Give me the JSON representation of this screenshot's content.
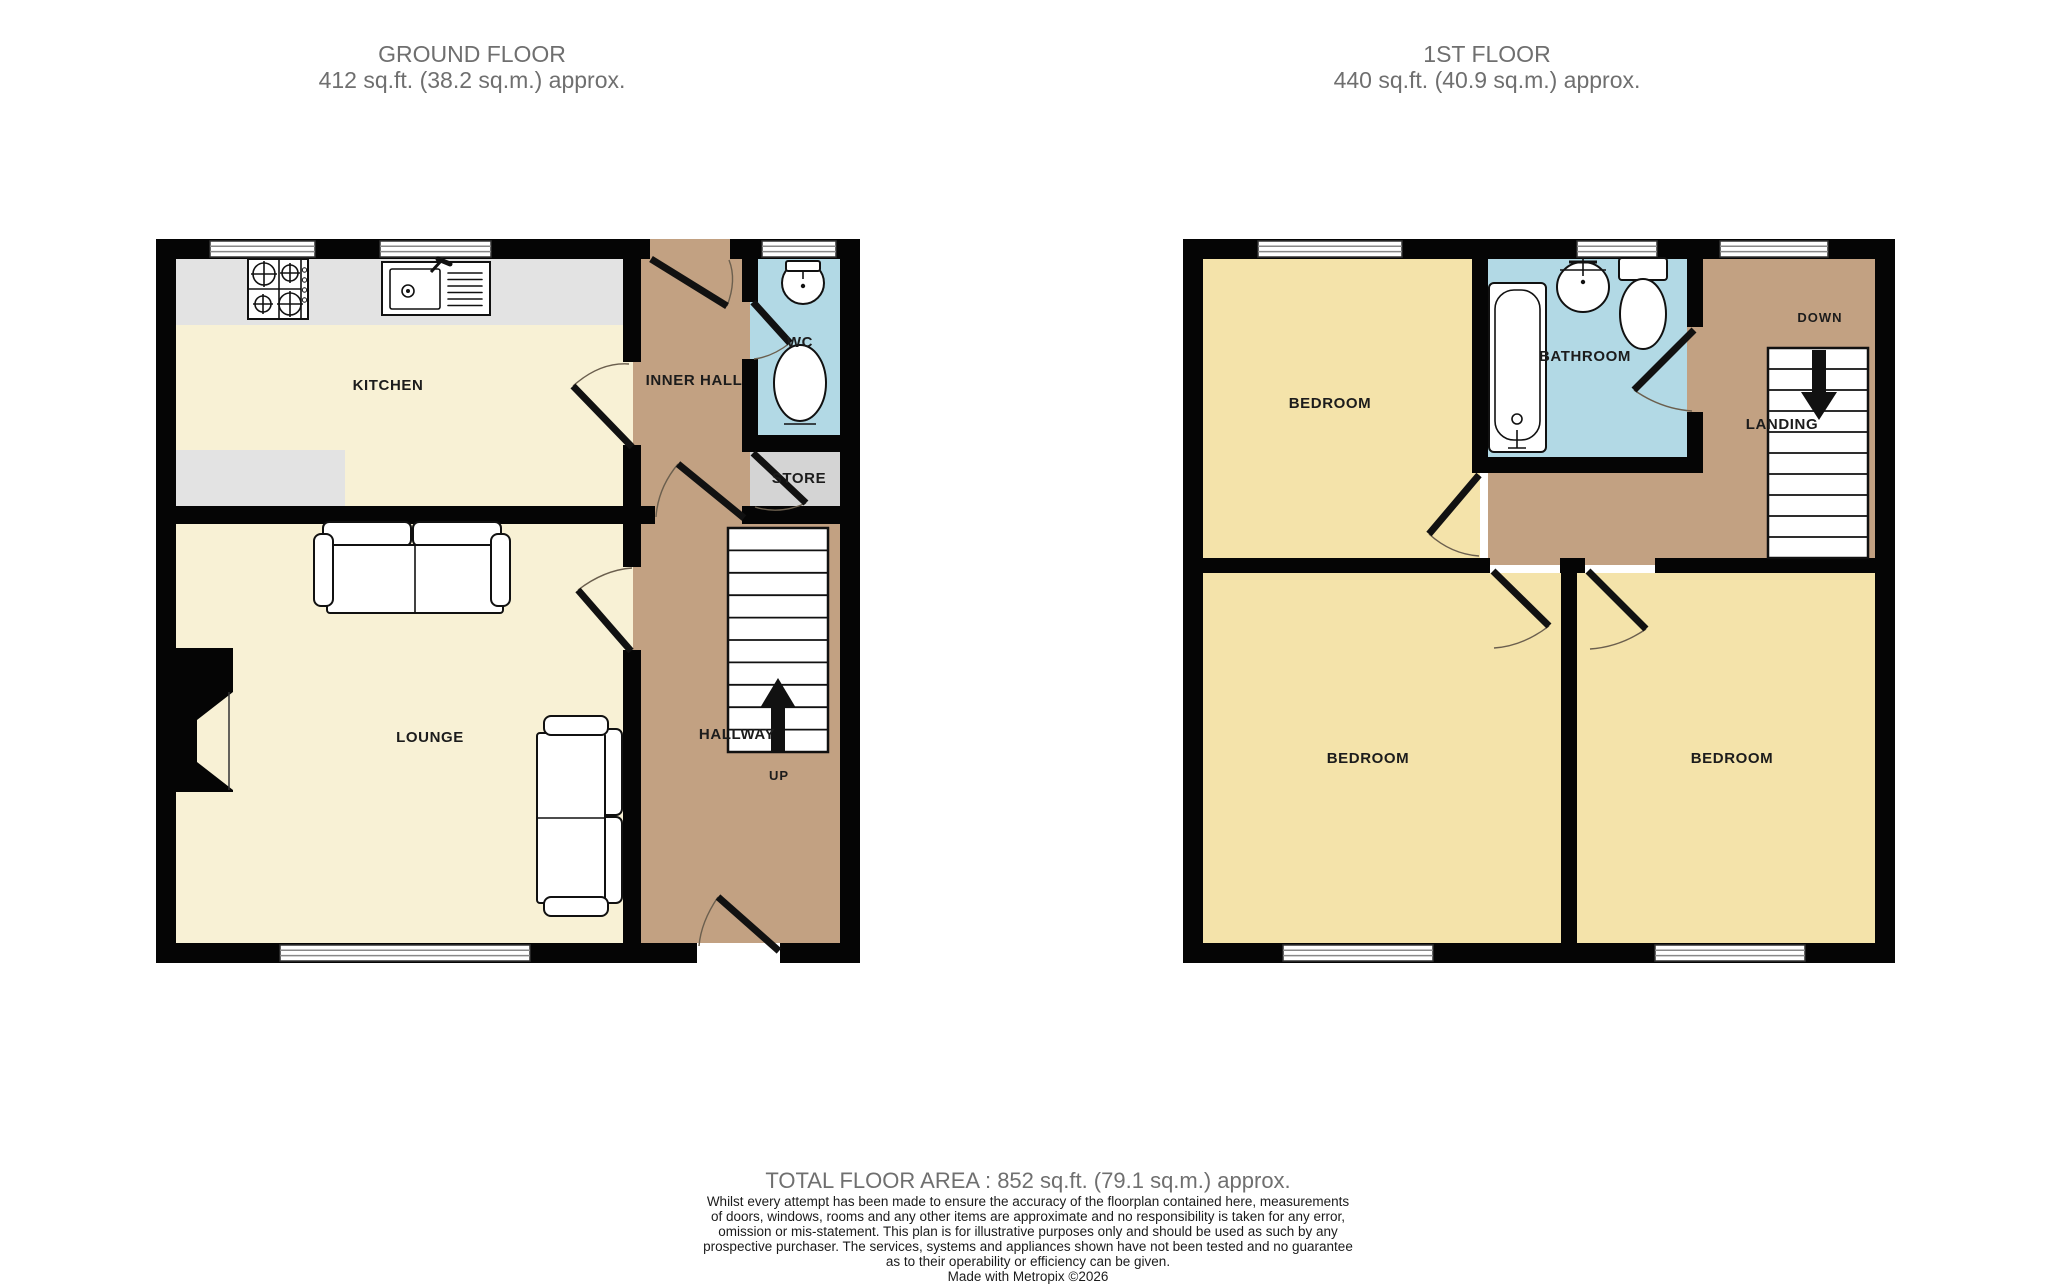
{
  "ground_floor": {
    "title": "GROUND FLOOR",
    "area": "412 sq.ft. (38.2 sq.m.) approx.",
    "labels": {
      "kitchen": "KITCHEN",
      "inner_hall": "INNER HALL",
      "wc": "WC",
      "store": "STORE",
      "lounge": "LOUNGE",
      "hallway": "HALLWAY",
      "stairs_direction": "UP"
    }
  },
  "first_floor": {
    "title": "1ST FLOOR",
    "area": "440 sq.ft. (40.9 sq.m.) approx.",
    "labels": {
      "bedroom_top_left": "BEDROOM",
      "bathroom": "BATHROOM",
      "landing": "LANDING",
      "stairs_direction": "DOWN",
      "bedroom_bottom_left": "BEDROOM",
      "bedroom_bottom_right": "BEDROOM"
    }
  },
  "footer": {
    "total_area": "TOTAL FLOOR AREA : 852 sq.ft. (79.1 sq.m.) approx.",
    "disclaimer_lines": [
      "Whilst every attempt has been made to ensure the accuracy of the floorplan contained here, measurements",
      "of doors, windows, rooms and any other items are approximate and no responsibility is taken for any error,",
      "omission or mis-statement. This plan is for illustrative purposes only and should be used as such by any",
      "prospective purchaser. The services, systems and appliances shown have not been tested and no guarantee",
      "as to their operability or efficiency can be given."
    ],
    "credit": "Made with Metropix ©2026"
  },
  "colors": {
    "wall": "#050505",
    "room_cream": "#f8f1d5",
    "room_yellow": "#f4e3aa",
    "hall_tan": "#c2a182",
    "wet_blue": "#b2d9e5",
    "store_grey": "#d4d4d4",
    "counter_grey": "#e3e3e3"
  }
}
